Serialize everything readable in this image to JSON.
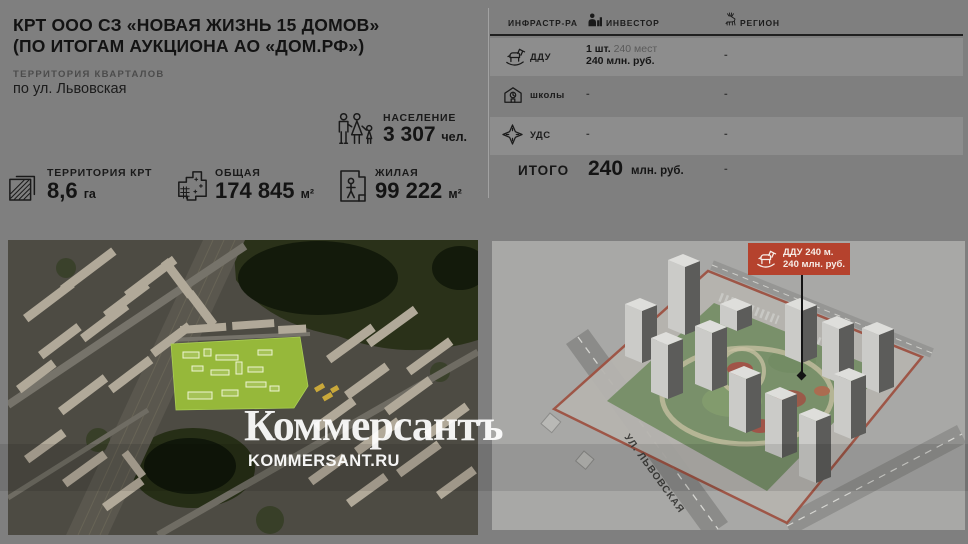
{
  "header": {
    "title_line1": "КРТ ООО СЗ «НОВАЯ ЖИЗНЬ 15 ДОМОВ»",
    "title_line2": "(ПО ИТОГАМ АУКЦИОНА АО «ДОМ.РФ»)",
    "subtitle_label": "ТЕРРИТОРИЯ КВАРТАЛОВ",
    "subtitle_value": "по ул. Львовская"
  },
  "stats": {
    "population": {
      "label": "НАСЕЛЕНИЕ",
      "value": "3 307",
      "unit": "чел.",
      "icon": "family-icon"
    },
    "territory": {
      "label": "ТЕРРИТОРИЯ КРТ",
      "value": "8,6",
      "unit": "га",
      "icon": "territory-icon"
    },
    "total_area": {
      "label": "ОБЩАЯ",
      "value": "174 845",
      "unit": "м²",
      "icon": "floorplan-icon"
    },
    "living_area": {
      "label": "ЖИЛАЯ",
      "value": "99 222",
      "unit": "м²",
      "icon": "resident-icon"
    }
  },
  "table": {
    "columns": [
      "ИНФРАСТР-РА",
      "ИНВЕСТОР",
      "РЕГИОН"
    ],
    "rows": [
      {
        "label": "ДДУ",
        "icon": "rocking-horse-icon",
        "investor_qty": "1 шт.",
        "investor_capacity": "240 мест",
        "investor_cost": "240 млн. руб.",
        "region": "-"
      },
      {
        "label": "школы",
        "icon": "school-icon",
        "investor": "-",
        "region": "-"
      },
      {
        "label": "УДС",
        "icon": "road-junction-icon",
        "investor": "-",
        "region": "-"
      }
    ],
    "total": {
      "label": "ИТОГО",
      "value": "240",
      "unit": "млн. руб.",
      "region": "-"
    }
  },
  "site_plan": {
    "street_label": "УЛ. ЛЬВОВСКАЯ",
    "callout_line1": "ДДУ 240 м.",
    "callout_line2": "240 млн. руб."
  },
  "watermark": {
    "logo": "Коммерсантъ",
    "site": "KOMMERSANT.RU"
  },
  "colors": {
    "background": "#7f7f7f",
    "accent_red": "#b5422d",
    "parcel_green": "#96b83a",
    "text_black": "#151515",
    "watermark_white": "#ffffff"
  }
}
